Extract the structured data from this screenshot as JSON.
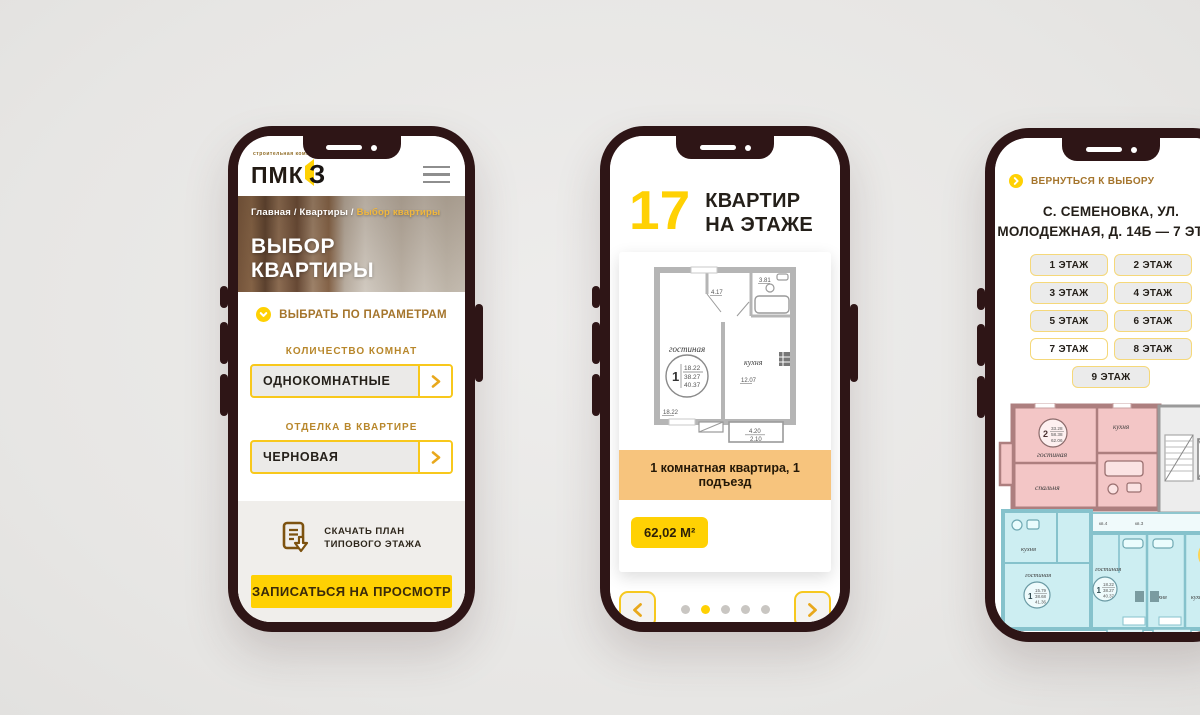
{
  "colors": {
    "accent_yellow": "#ffd103",
    "gold_text": "#b8872b",
    "frame_brown": "#2e1516",
    "banner_orange": "#f7c47d",
    "plan_pink": "#f3c6c6",
    "plan_blue": "#cdeef2"
  },
  "phone1": {
    "logo": {
      "tagline": "строительная компания",
      "name": "ПМК",
      "digit": "З"
    },
    "breadcrumb": {
      "prefix": "Главная / Квартиры / ",
      "current": "Выбор квартиры"
    },
    "hero_title": "ВЫБОР КВАРТИРЫ",
    "params_toggle": "ВЫБРАТЬ ПО ПАРАМЕТРАМ",
    "filters": [
      {
        "label": "КОЛИЧЕСТВО КОМНАТ",
        "value": "ОДНОКОМНАТНЫЕ"
      },
      {
        "label": "ОТДЕЛКА В КВАРТИРЕ",
        "value": "ЧЕРНОВАЯ"
      }
    ],
    "download": {
      "line1": "СКАЧАТЬ ПЛАН",
      "line2": "ТИПОВОГО ЭТАЖА"
    },
    "cta": "ЗАПИСАТЬСЯ НА ПРОСМОТР"
  },
  "phone2": {
    "count": "17",
    "count_label_line1": "КВАРТИР",
    "count_label_line2": "НА ЭТАЖЕ",
    "plan": {
      "living": "гостиная",
      "kitchen": "кухня",
      "rooms": "1",
      "area_living": "18.22",
      "area_usable": "38.27",
      "area_total": "40.37",
      "dim_hall": "4.17",
      "dim_bath": "3.81",
      "dim_kitchen": "12.07",
      "dim_living": "18.22",
      "balcony_top": "4.20",
      "balcony_bottom": "2.10"
    },
    "banner": "1 комнатная квартира, 1 подъезд",
    "area_badge": "62,02 М²"
  },
  "phone3": {
    "back": "ВЕРНУТЬСЯ К ВЫБОРУ",
    "title_line1": "С. СЕМЕНОВКА, УЛ.",
    "title_line2": "МОЛОДЕЖНАЯ, Д. 14Б — 7 ЭТАЖ",
    "floors": [
      {
        "label": "1 ЭТАЖ"
      },
      {
        "label": "2 ЭТАЖ"
      },
      {
        "label": "3 ЭТАЖ"
      },
      {
        "label": "4 ЭТАЖ"
      },
      {
        "label": "5 ЭТАЖ"
      },
      {
        "label": "6 ЭТАЖ"
      },
      {
        "label": "7 ЭТАЖ"
      },
      {
        "label": "8 ЭТАЖ"
      },
      {
        "label": "9 ЭТАЖ"
      }
    ],
    "plan": {
      "flat2": {
        "rooms": "2",
        "a": "33.28",
        "b": "58.38",
        "c": "62.06"
      },
      "flat1a": {
        "rooms": "1",
        "a": "15.79",
        "b": "38.68",
        "c": "41.36"
      },
      "flat1b": {
        "rooms": "1",
        "a": "18.22",
        "b": "38.27",
        "c": "40.37"
      },
      "living": "гостиная",
      "bedroom": "спальня",
      "kitchen": "кухня",
      "corridor1": "кв.4",
      "corridor2": "кв.3",
      "corridor3": "кв.1",
      "corridor4": "кв.2"
    }
  }
}
